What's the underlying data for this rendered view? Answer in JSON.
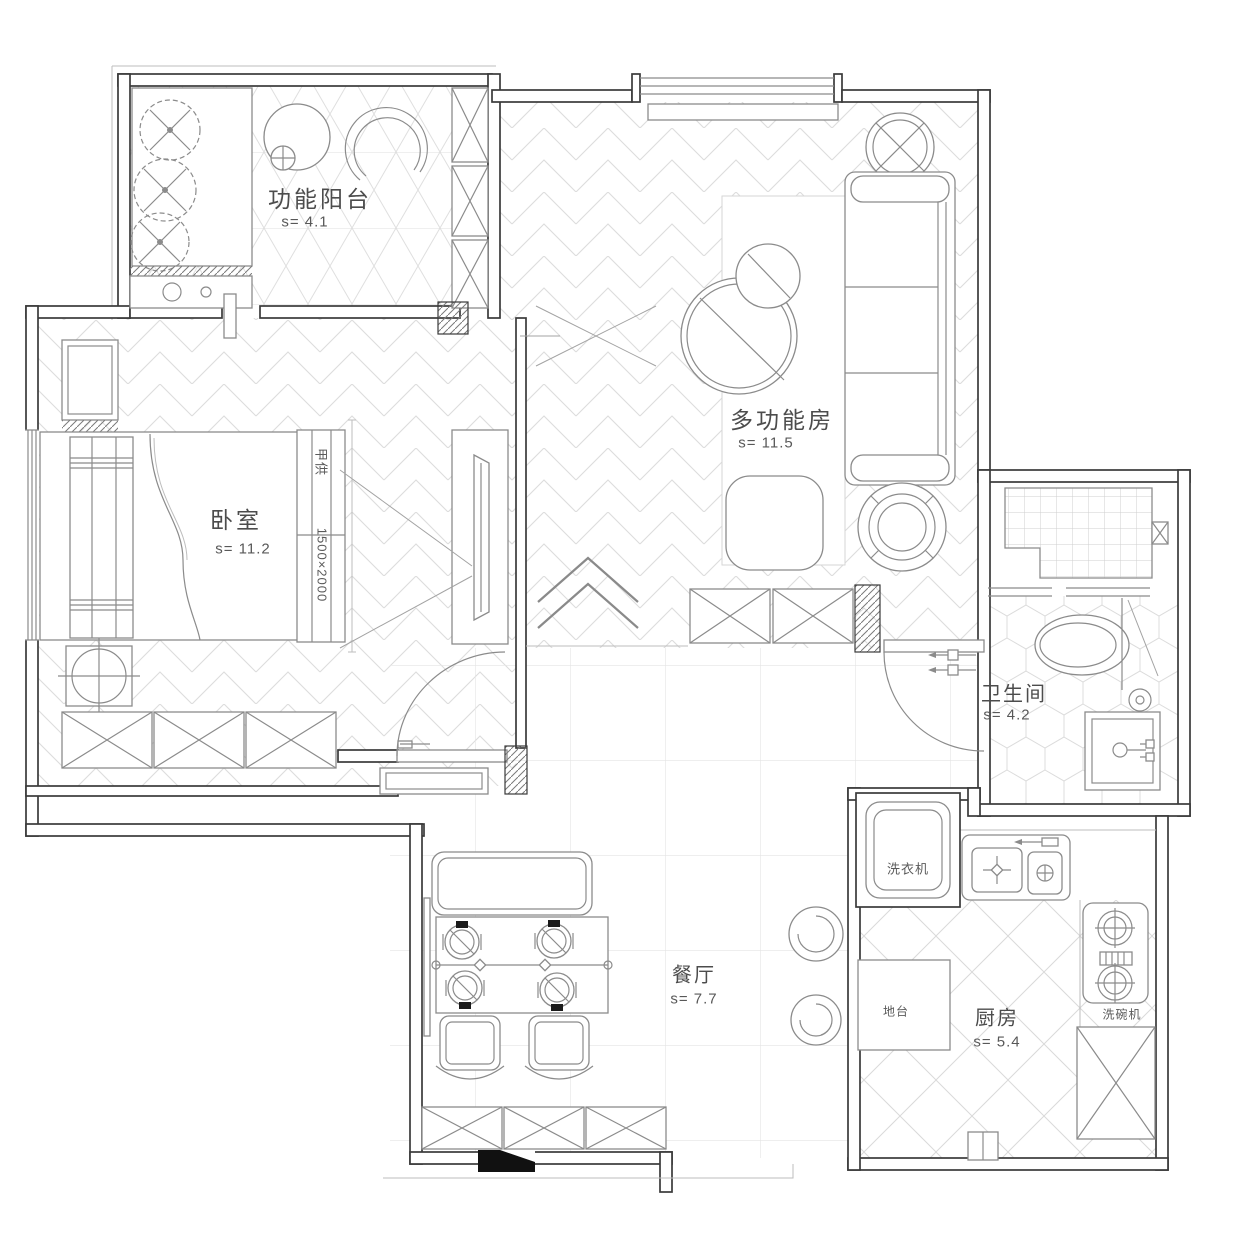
{
  "rooms": {
    "balcony": {
      "name": "功能阳台",
      "area": "s= 4.1"
    },
    "bedroom": {
      "name": "卧室",
      "area": "s= 11.2"
    },
    "multi_room": {
      "name": "多功能房",
      "area": "s= 11.5"
    },
    "bathroom": {
      "name": "卫生间",
      "area": "s= 4.2"
    },
    "dining": {
      "name": "餐厅",
      "area": "s= 7.7"
    },
    "kitchen": {
      "name": "厨房",
      "area": "s= 5.4"
    }
  },
  "annotations": {
    "washer": "洗衣机",
    "dishwasher": "洗碗机",
    "platform": "地台",
    "owner_supplied": "甲供",
    "bed_size": "1500×2000"
  },
  "colors": {
    "background": "#ffffff",
    "wall_line": "#3a3a3a",
    "furniture_line": "#8b8b8b",
    "pattern_line": "#dcdcdc",
    "text": "#4c4c4c",
    "section_mark": "#111111"
  }
}
